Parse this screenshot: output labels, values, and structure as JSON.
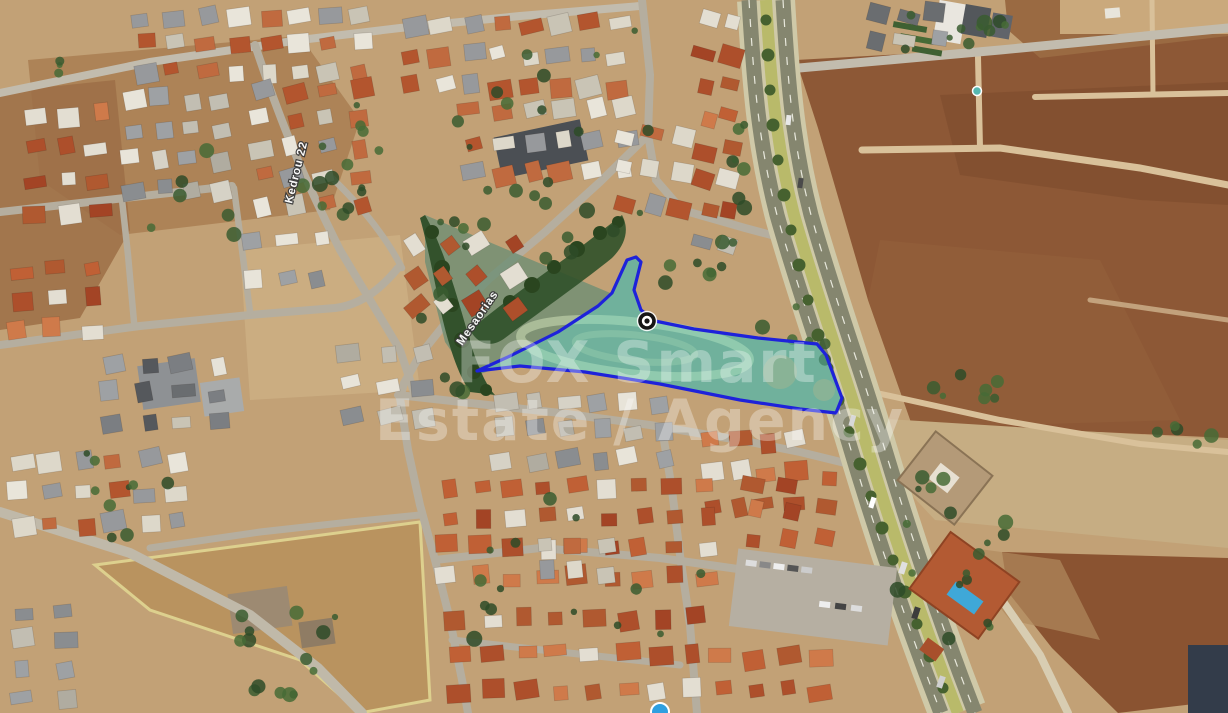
{
  "app": {
    "type": "satellite-map-view",
    "description": "Aerial satellite view of a residential area beside a highway, with a land plot highlighted by a blue polygon, a location marker, and an estate-agency watermark"
  },
  "map": {
    "street_labels": [
      {
        "text": "Mesaorias",
        "transform": "translate(462,346) rotate(-55)"
      },
      {
        "text": "Kedrou 22",
        "transform": "translate(292,204) rotate(-76)"
      }
    ],
    "plot": {
      "polygon_points": "636,257 627,260 612,293 598,306 558,332 510,356 477,371 520,366 585,372 660,384 740,400 800,409 836,413 842,398 826,355 817,344 758,338 694,329 655,321 641,310 634,290 641,262",
      "marker_transform": "translate(647,321)",
      "outline_color": "#1e22da",
      "fill_color": "rgba(108,222,205,0.40)"
    },
    "watermark": {
      "line1": "FOX Smart",
      "line2": "Estate / Agency",
      "color": "#ffffff",
      "opacity": "0.32"
    }
  },
  "colors": {
    "ground_tan": "#c2a176",
    "field_brown": "#8d5836",
    "highway_median": "#b9ba6a",
    "asphalt": "#85866f",
    "roof_red": "#ad4f2b",
    "roof_white": "#e9e5da",
    "vegetation": "#33522c",
    "pool_blue": "#3fa8d8",
    "marker_black": "#151515",
    "label_white": "#ffffff"
  }
}
